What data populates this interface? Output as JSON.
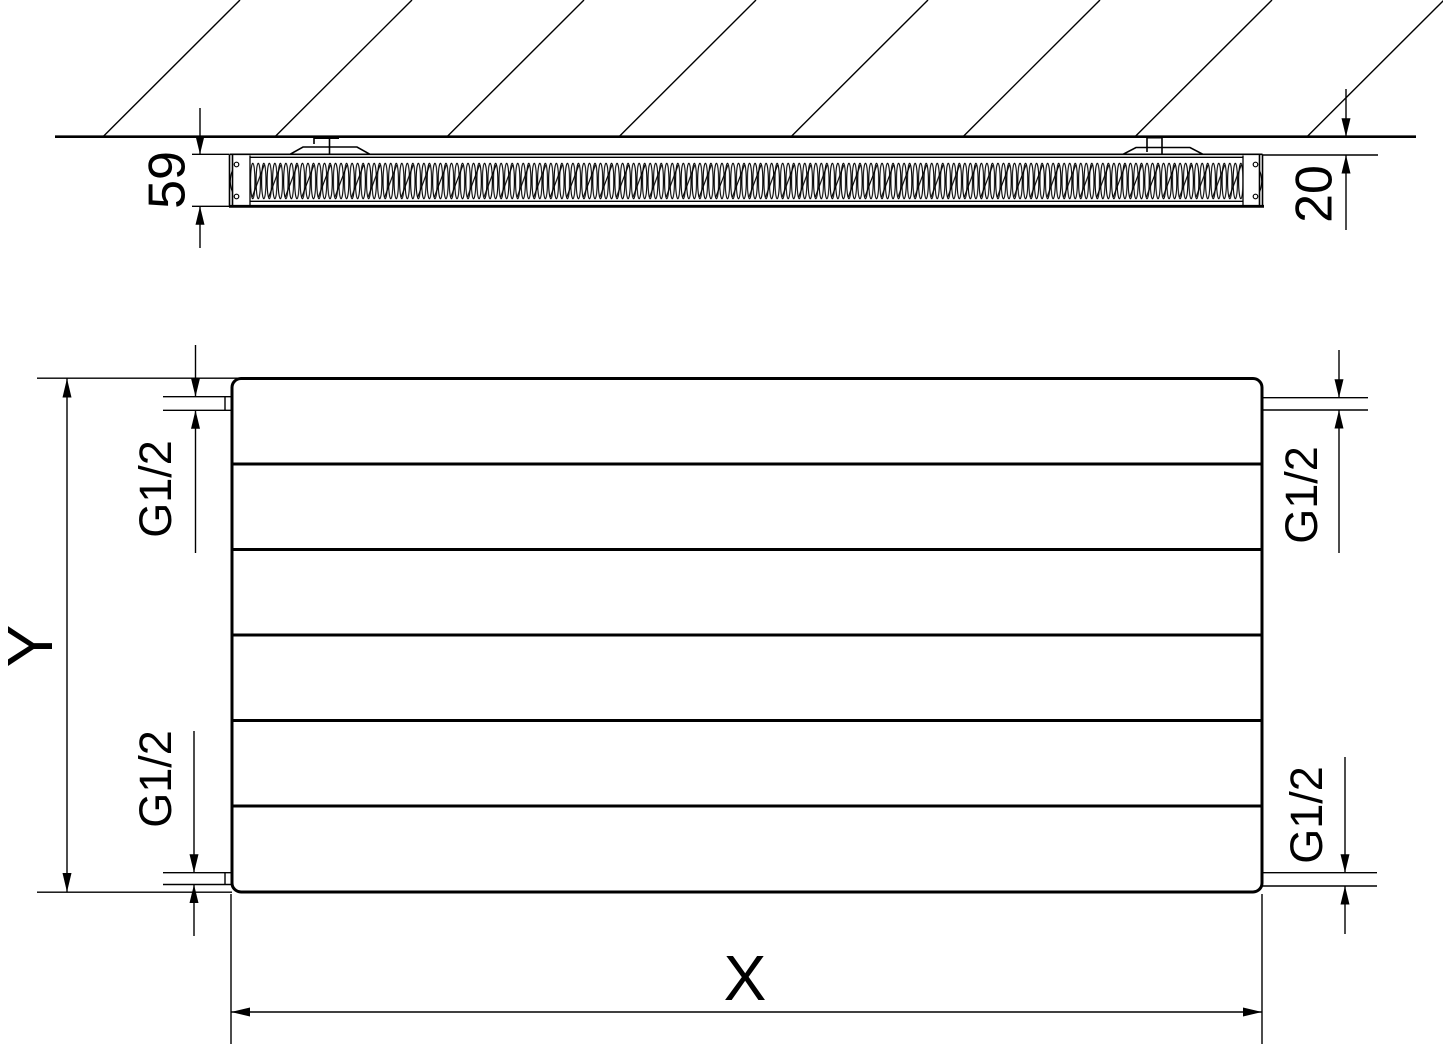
{
  "top_view": {
    "depth_dimension": "59",
    "wall_distance_dimension": "20"
  },
  "front_view": {
    "height_dimension": "Y",
    "width_dimension": "X",
    "connections": {
      "top_left": "G1/2",
      "top_right": "G1/2",
      "bottom_left": "G1/2",
      "bottom_right": "G1/2"
    }
  },
  "colors": {
    "line": "#000000",
    "background": "#ffffff"
  }
}
